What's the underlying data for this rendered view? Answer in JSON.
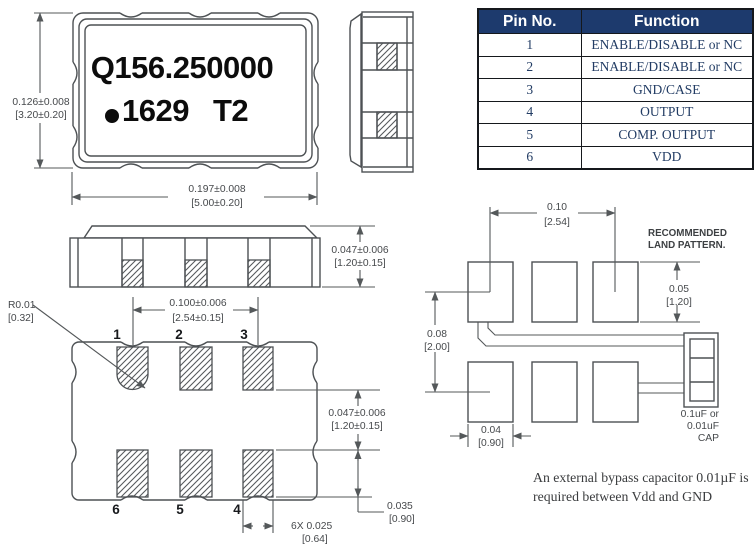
{
  "colors": {
    "line": "#4d5154",
    "table_header_bg": "#1d3a6d",
    "table_text": "#223c64",
    "marking_text": "#0c0c0c"
  },
  "top_view": {
    "marking_line1": "Q156.250000",
    "marking_line2": "1629",
    "marking_line2b": "T2",
    "dim_height_in": "0.126±0.008",
    "dim_height_mm": "[3.20±0.20]",
    "dim_width_in": "0.197±0.008",
    "dim_width_mm": "[5.00±0.20]"
  },
  "front_view": {
    "dim_thickness_in": "0.047±0.006",
    "dim_thickness_mm": "[1.20±0.15]"
  },
  "bottom_view": {
    "pin_labels_top": [
      "1",
      "2",
      "3"
    ],
    "pin_labels_bottom": [
      "6",
      "5",
      "4"
    ],
    "radius_in": "R0.01",
    "radius_mm": "[0.32]",
    "dim_pitch_in": "0.100±0.006",
    "dim_pitch_mm": "[2.54±0.15]",
    "dim_row_gap_in": "0.047±0.006",
    "dim_row_gap_mm": "[1.20±0.15]",
    "dim_pad_height_in": "0.035",
    "dim_pad_height_mm": "[0.90]",
    "dim_pad_width_in": "6X 0.025",
    "dim_pad_width_mm": "[0.64]"
  },
  "land_pattern": {
    "title_line1": "RECOMMENDED",
    "title_line2": "LAND PATTERN.",
    "dim_pitch_in": "0.10",
    "dim_pitch_mm": "[2.54]",
    "dim_pad_height_in": "0.05",
    "dim_pad_height_mm": "[1.20]",
    "dim_row_gap_in": "0.08",
    "dim_row_gap_mm": "[2.00]",
    "dim_pad_width_in": "0.04",
    "dim_pad_width_mm": "[0.90]",
    "cap_line1": "0.1uF or",
    "cap_line2": "0.01uF",
    "cap_line3": "CAP"
  },
  "pin_table": {
    "headers": [
      "Pin No.",
      "Function"
    ],
    "rows": [
      {
        "pin": "1",
        "function": "ENABLE/DISABLE or NC"
      },
      {
        "pin": "2",
        "function": "ENABLE/DISABLE or NC"
      },
      {
        "pin": "3",
        "function": "GND/CASE"
      },
      {
        "pin": "4",
        "function": "OUTPUT"
      },
      {
        "pin": "5",
        "function": "COMP. OUTPUT"
      },
      {
        "pin": "6",
        "function": "VDD"
      }
    ]
  },
  "note": {
    "line1": "An external bypass capacitor 0.01µF is",
    "line2": "required between Vdd and GND"
  }
}
